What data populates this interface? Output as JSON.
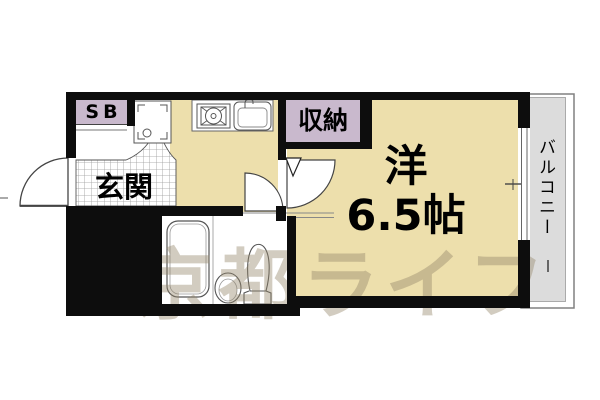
{
  "plan": {
    "rooms": {
      "main_room": {
        "type_label": "洋",
        "size_label": "6.5帖"
      },
      "closet_label": "収納",
      "entrance_label": "玄関",
      "shoe_box_label": "SB",
      "balcony_label": "バルコニー"
    },
    "watermark_text": "京都ライフ",
    "colors": {
      "floor_tan": "#EDDFAC",
      "closet_lavender": "#C9B9CD",
      "balcony_gray": "#DCDCDC",
      "wall_black": "#0d0d0d",
      "grid_line": "#9a9a9a",
      "fixture_line": "#555555"
    }
  }
}
